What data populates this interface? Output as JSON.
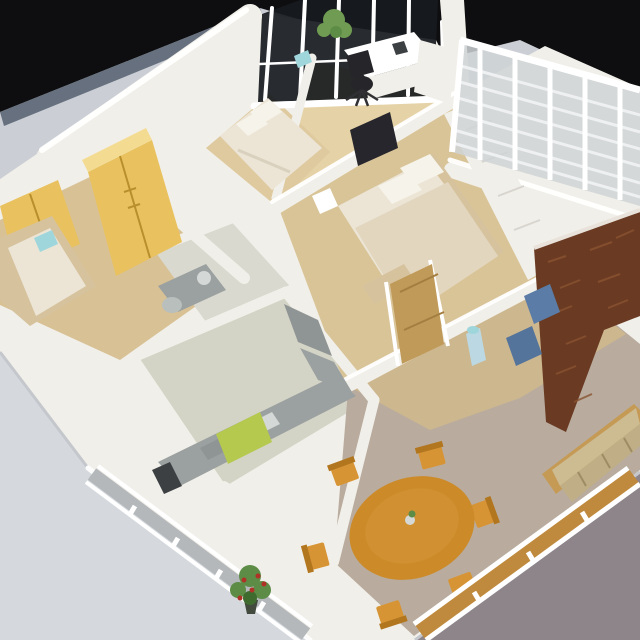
{
  "scene": {
    "type": "photograph",
    "subject": "architectural scale model of an apartment floor plan, aerial oblique view",
    "setting": "white miniature model sitting on a gray table against a black backdrop",
    "objects": [
      "black backdrop",
      "gray table surface",
      "white model walls",
      "glass curtain wall with white mullions",
      "balcony with white slat railing",
      "study with desk, black office chair, bookshelf and green potted plant",
      "small bedroom with white bed",
      "master bedroom with double bed, pillows, dark picture frame and white closet panels",
      "left bedroom with yellow wardrobes and wood-frame bed",
      "bathroom with gray fixtures",
      "kitchen with gray counters, dark appliance and lime green cabinet",
      "open living-dining room",
      "round orange wooden dining table with six chairs and small centerpiece",
      "dark brown textured accent wall",
      "blue sofa cushions",
      "beige sofa on wood floor strip",
      "wooden hall door",
      "balcony corner with red flowering potted plant",
      "window walls with gray and wood-toned panes"
    ]
  },
  "palette": {
    "black": "#0e0e10",
    "slate": "#66707e",
    "surface": "#cbcfd5",
    "surfaceLight": "#d5d9de",
    "surfaceDark": "#8e858b",
    "wall": "#f1efe9",
    "wallBright": "#ffffff",
    "wallShade": "#c4c7cc",
    "glassDark": "#171a1e",
    "glassGray": "#b4b8ba",
    "glassWood": "#c08a3e",
    "floorStudy": "#e5d2a6",
    "floorBedroomTop": "#dfcaa0",
    "floorBedroomLeft": "#d8c195",
    "floorMaster": "#d9c498",
    "floorHall": "#cfb88d",
    "floorDining": "#b9ac9e",
    "floorKitchen": "#d4d4c6",
    "floorBath": "#d9d9cf",
    "counterGray": "#9ba1a0",
    "counterDark": "#8f9594",
    "applianceDark": "#3c4043",
    "lime": "#b5c94f",
    "wardrobe": "#e9c25f",
    "wardrobeLight": "#f3dc92",
    "wardrobeSeam": "#b98f2e",
    "doorWood": "#c09a58",
    "tableOrange": "#cc8a28",
    "chairOrange": "#d79434",
    "chairBack": "#b2761f",
    "sofaBlue": "#5a7ca6",
    "sofaBlue2": "#54749c",
    "sofaBeige": "#cdbb92",
    "sofaBeigeSeat": "#bfae86",
    "woodStrip": "#c59a55",
    "brownWall": "#6a3a22",
    "brickLight": "#8a5432",
    "plantGreen": "#5d8c46",
    "plantGreenLight": "#6f9c52",
    "plantDark": "#3f6b2f",
    "plantRed": "#b03226",
    "potDark": "#434b3e",
    "chairBlack": "#26262a",
    "bedWhite": "#ece5d6",
    "bedDuvet": "#e2d6bf",
    "pillow": "#f6f3ea",
    "headboard": "#d6c39e",
    "frameDark": "#26262c",
    "cyanItem": "#9fd6dc",
    "waterBlue": "#bcd8e2",
    "fixtureGray": "#b9bfbc",
    "sinkWhite": "#d4d8d6"
  }
}
